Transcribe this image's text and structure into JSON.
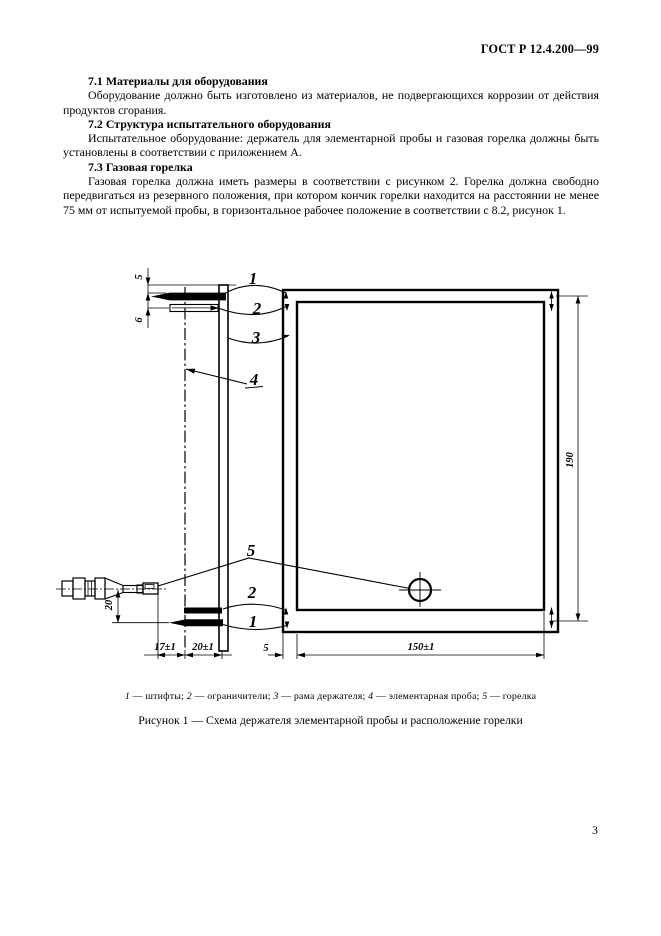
{
  "document": {
    "code": "ГОСТ Р 12.4.200—99",
    "page_number": "3"
  },
  "sections": [
    {
      "heading": "7.1 Материалы для оборудования",
      "body": "Оборудование должно быть изготовлено из материалов, не подвергающихся коррозии от действия продуктов сгорания."
    },
    {
      "heading": "7.2 Структура испытательного оборудования",
      "body": "Испытательное оборудование: держатель для элементарной пробы и газовая горелка должны быть установлены в соответствии с приложением А."
    },
    {
      "heading": "7.3 Газовая горелка",
      "body": "Газовая горелка должна иметь размеры в соответствии с рисунком 2. Горелка должна свободно передвигаться из резервного положения, при котором кончик горелки находится на расстоянии не менее 75 мм от испытуемой пробы, в горизонтальное рабочее положение в соответствии с 8.2, рисунок 1."
    }
  ],
  "figure": {
    "callouts": {
      "pin_top": "1",
      "stop_top": "2",
      "frame": "3",
      "specimen": "4",
      "burner": "5",
      "stop_bottom": "2",
      "pin_bottom": "1"
    },
    "dims": {
      "pin_edge_offset": "5",
      "stop_pin_gap": "6",
      "burner_axis_height": "20",
      "tip_to_specimen": "17±1",
      "specimen_to_frame": "20±1",
      "frame_inset": "5",
      "opening_width": "150±1",
      "opening_height": "190"
    },
    "legend_parts": [
      {
        "n": "1",
        "t": "штифты"
      },
      {
        "n": "2",
        "t": "ограничители"
      },
      {
        "n": "3",
        "t": "рама держателя"
      },
      {
        "n": "4",
        "t": "элементарная проба"
      },
      {
        "n": "5",
        "t": "горелка"
      }
    ],
    "caption": "Рисунок 1 — Схема держателя элементарной пробы и расположение горелки"
  }
}
